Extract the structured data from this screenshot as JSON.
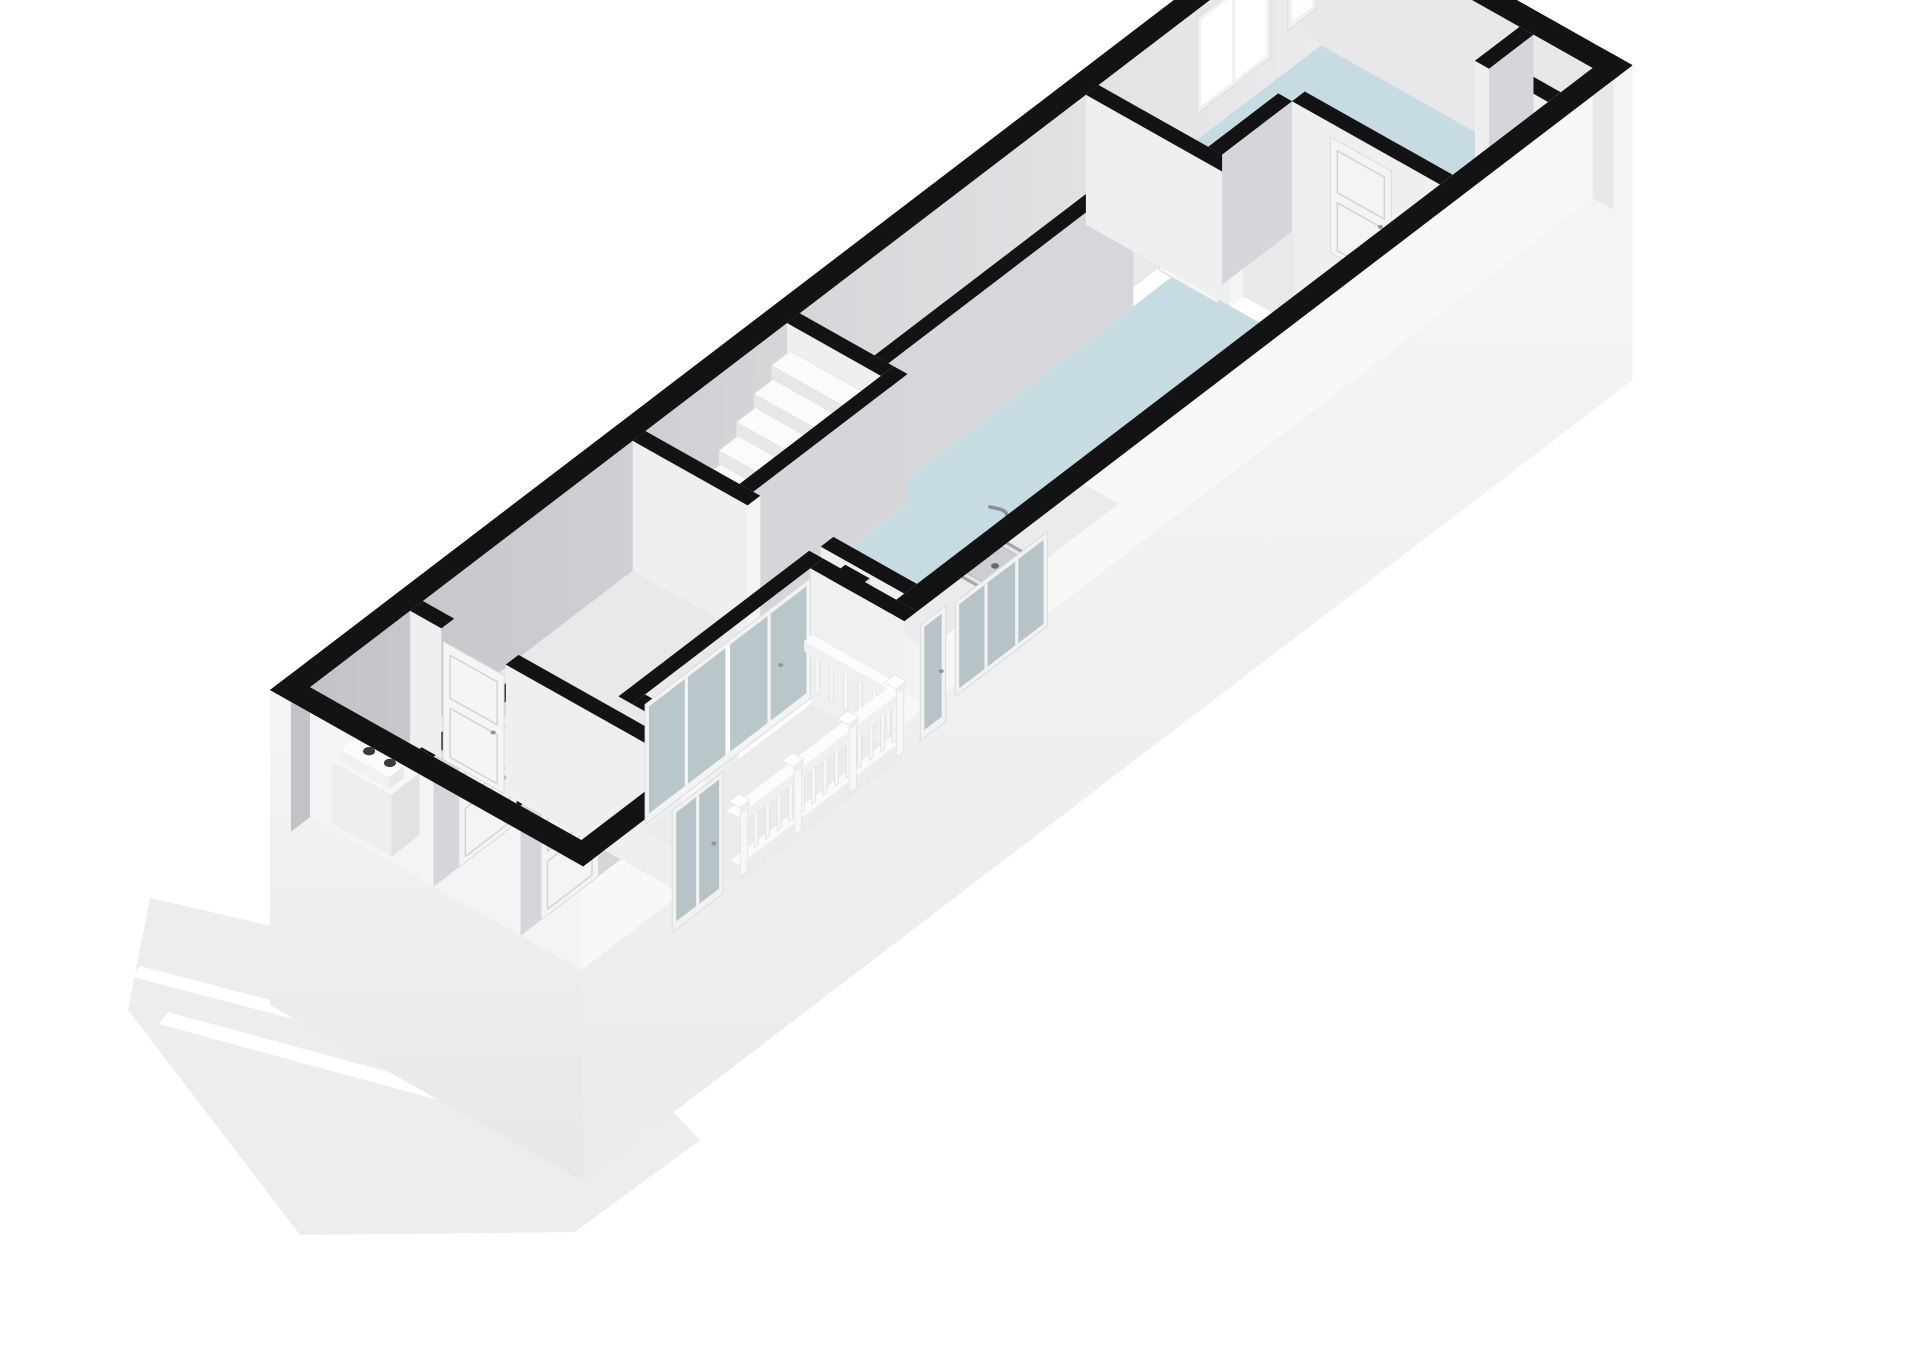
{
  "meta": {
    "width": 1920,
    "height": 1358,
    "background": "#ffffff",
    "description": "3D floor plan render"
  },
  "projection": {
    "ox": 270,
    "oy": 820,
    "ux": 0.795,
    "uy": -0.607,
    "vx": 0.87,
    "vy": 0.49,
    "h": 130,
    "ground": -185
  },
  "palette": {
    "wall_top": "#131315",
    "face_se": "#d6d6da",
    "face_sw": "#eeeff1",
    "cap": "#f5f5f6",
    "floor_gray": "#e9e9eb",
    "floor_blue": "#c7dbe2",
    "glass_pale": "#bac7ca",
    "glass_white": "#ffffff",
    "frame": "#f3f3f4",
    "ground": "#ededee",
    "stripe": "#ffffff",
    "nw_grad": [
      "#c2c2c7",
      "#ececee"
    ],
    "gable_grad": [
      "#f5f5f6",
      "#e7e7e9"
    ],
    "facade_grad": [
      "#f6f6f7",
      "#ebebed"
    ]
  },
  "scene": [
    {
      "name": "ground-plane",
      "type": "sp",
      "pts": [
        [
          150,
          898
        ],
        [
          560,
          992
        ],
        [
          700,
          1140
        ],
        [
          575,
          1232
        ],
        [
          300,
          1235
        ],
        [
          128,
          1010
        ]
      ],
      "fill": "#ededee"
    },
    {
      "name": "ground-stripe-1",
      "type": "sp",
      "pts": [
        [
          168,
          1012
        ],
        [
          565,
          1120
        ],
        [
          556,
          1132
        ],
        [
          159,
          1024
        ]
      ],
      "fill": "#ffffff"
    },
    {
      "name": "ground-stripe-2",
      "type": "sp",
      "pts": [
        [
          140,
          966
        ],
        [
          430,
          1042
        ],
        [
          423,
          1053
        ],
        [
          133,
          977
        ]
      ],
      "fill": "#ffffff"
    },
    {
      "name": "gable-exterior-face",
      "type": "pp",
      "pts": [
        [
          0,
          0,
          130
        ],
        [
          0,
          360,
          130
        ],
        [
          0,
          360,
          -185
        ],
        [
          0,
          0,
          -185
        ]
      ],
      "fill": "url(#gGable)"
    },
    {
      "name": "facade-exterior-face",
      "type": "pp",
      "pts": [
        [
          0,
          360,
          130
        ],
        [
          196,
          360,
          130
        ],
        [
          196,
          360,
          -6
        ],
        [
          404,
          360,
          -6
        ],
        [
          404,
          360,
          130
        ],
        [
          1320,
          360,
          130
        ],
        [
          1320,
          360,
          -185
        ],
        [
          0,
          360,
          -185
        ]
      ],
      "fill": "url(#gFacade)"
    },
    {
      "name": "nw-wall",
      "type": "wu",
      "u": [
        0,
        1320
      ],
      "v": 0,
      "t": 24,
      "face": "url(#gNW)"
    },
    {
      "name": "ne-end-wall",
      "type": "wv",
      "v": [
        0,
        360
      ],
      "u": 1296,
      "t": 24,
      "face": "#e8e8ea",
      "capB": true
    },
    {
      "name": "bedroom-window-large",
      "type": "pan",
      "plane": "v",
      "at": 24,
      "a": [
        1140,
        1232
      ],
      "z": [
        26,
        122
      ],
      "frame": "#f0f0f1",
      "glass": "#ffffff",
      "mull": 1
    },
    {
      "name": "bedroom-window-small",
      "type": "pan",
      "plane": "v",
      "at": 24,
      "a": [
        1254,
        1290
      ],
      "z": [
        40,
        112
      ],
      "frame": "#f0f0f1",
      "glass": "#fdfdfd",
      "mull": 0
    },
    {
      "name": "hall-floor",
      "type": "pp",
      "pts": [
        [
          24,
          24,
          0
        ],
        [
          446,
          24,
          0
        ],
        [
          446,
          336,
          0
        ],
        [
          420,
          336,
          0
        ],
        [
          420,
          236,
          0
        ],
        [
          180,
          236,
          0
        ],
        [
          180,
          336,
          0
        ],
        [
          24,
          336,
          0
        ]
      ],
      "fill": "#e9e9eb"
    },
    {
      "name": "stair-room-floor",
      "type": "pp",
      "pts": [
        [
          446,
          24,
          0
        ],
        [
          624,
          24,
          0
        ],
        [
          624,
          132,
          0
        ],
        [
          446,
          132,
          0
        ]
      ],
      "fill": "#e8e8ea"
    },
    {
      "name": "corridor-floor",
      "type": "pp",
      "pts": [
        [
          640,
          24,
          0
        ],
        [
          1000,
          24,
          0
        ],
        [
          1000,
          110,
          0
        ],
        [
          640,
          110,
          0
        ]
      ],
      "fill": "#e9e9eb"
    },
    {
      "name": "living-room-floor",
      "type": "pp",
      "pts": [
        [
          446,
          148,
          0
        ],
        [
          640,
          148,
          0
        ],
        [
          640,
          126,
          0
        ],
        [
          1000,
          126,
          0
        ],
        [
          1000,
          336,
          0
        ],
        [
          446,
          336,
          0
        ]
      ],
      "fill": "#c7dbe2"
    },
    {
      "name": "ne-closet-floor",
      "type": "pp",
      "pts": [
        [
          1016,
          150,
          0
        ],
        [
          1104,
          150,
          0
        ],
        [
          1104,
          336,
          0
        ],
        [
          1016,
          336,
          0
        ]
      ],
      "fill": "#e9e9eb"
    },
    {
      "name": "bedroom-floor",
      "type": "pp",
      "pts": [
        [
          1016,
          24,
          0
        ],
        [
          1296,
          24,
          0
        ],
        [
          1296,
          336,
          0
        ],
        [
          1120,
          336,
          0
        ],
        [
          1120,
          166,
          0
        ],
        [
          1016,
          166,
          0
        ]
      ],
      "fill": "#c7dbe2"
    },
    {
      "name": "corridor-partition",
      "type": "wu",
      "u": [
        640,
        948
      ],
      "v": 110,
      "t": 16,
      "face": "#d7d7db"
    },
    {
      "name": "living-door-leaf",
      "type": "pan",
      "plane": "u",
      "at": 996,
      "a": [
        112,
        180
      ],
      "z": [
        0,
        118
      ],
      "frame": "#f6f6f7",
      "door": true,
      "handle": true
    },
    {
      "name": "living-ne-partition-low",
      "type": "wv",
      "v": [
        24,
        190
      ],
      "u": 1000,
      "t": 16,
      "capB": true
    },
    {
      "name": "living-ne-partition-high",
      "type": "wv",
      "v": [
        264,
        336
      ],
      "u": 1000,
      "t": 16
    },
    {
      "name": "ne-closet-wall-back",
      "type": "wu",
      "u": [
        1016,
        1104
      ],
      "v": 150,
      "t": 16
    },
    {
      "name": "ne-closet-wall-side",
      "type": "wv",
      "v": [
        166,
        336
      ],
      "u": 1104,
      "t": 16
    },
    {
      "name": "ne-closet-door",
      "type": "pan",
      "plane": "u",
      "at": 1104,
      "a": [
        210,
        280
      ],
      "z": [
        0,
        116
      ],
      "frame": "#f4f4f5",
      "door": true,
      "handle": true
    },
    {
      "name": "corner-niche-wall-side",
      "type": "wv",
      "v": [
        252,
        336
      ],
      "u": 1240,
      "t": 16
    },
    {
      "name": "corner-niche-wall-back",
      "type": "wu",
      "u": [
        1240,
        1296
      ],
      "v": 252,
      "t": 16
    },
    {
      "name": "stair-ne-wall",
      "type": "wv",
      "v": [
        24,
        132
      ],
      "u": 624,
      "t": 16
    },
    {
      "name": "staircase",
      "type": "stair",
      "u0": 468,
      "n": 7,
      "du": 22,
      "v": [
        28,
        128
      ],
      "z0": 14,
      "dz": 15
    },
    {
      "name": "stair-se-wall",
      "type": "wu",
      "u": [
        446,
        640
      ],
      "v": 132,
      "t": 16,
      "capA": true
    },
    {
      "name": "gable-interior-face",
      "type": "pp",
      "pts": [
        [
          24,
          24,
          130
        ],
        [
          24,
          336,
          130
        ],
        [
          24,
          336,
          0
        ],
        [
          24,
          24,
          0
        ]
      ],
      "fill": "#f4f4f6"
    },
    {
      "name": "facade-interior-sw",
      "type": "pp",
      "pts": [
        [
          24,
          336,
          130
        ],
        [
          180,
          336,
          130
        ],
        [
          180,
          336,
          0
        ],
        [
          24,
          336,
          0
        ]
      ],
      "fill": "#f8f8f9"
    },
    {
      "name": "facade-interior-ne",
      "type": "pp",
      "pts": [
        [
          404,
          336,
          130
        ],
        [
          1296,
          336,
          130
        ],
        [
          1296,
          336,
          0
        ],
        [
          404,
          336,
          0
        ]
      ],
      "fill": "#f8f8f9"
    },
    {
      "name": "kitchen-counter",
      "type": "box",
      "u": [
        460,
        700
      ],
      "v": [
        280,
        336
      ],
      "z": [
        0,
        56
      ],
      "top": "#ebebed",
      "sw": "#f3f3f4",
      "nw": "#f0f0f1"
    },
    {
      "name": "kitchen-sink",
      "type": "sink",
      "u": [
        547,
        603
      ],
      "v": [
        290,
        326
      ],
      "z": 56
    },
    {
      "name": "kitchen-faucet",
      "type": "faucet",
      "at": [
        600,
        294,
        56
      ]
    },
    {
      "name": "hall-partition-low",
      "type": "wv",
      "v": [
        24,
        156
      ],
      "u": 430,
      "t": 16,
      "capB": true
    },
    {
      "name": "hall-partition-high",
      "type": "wv",
      "v": [
        240,
        336
      ],
      "u": 430,
      "t": 16
    },
    {
      "name": "duct-pillar",
      "type": "box",
      "u": [
        398,
        426
      ],
      "v": [
        272,
        300
      ],
      "z": [
        0,
        130
      ],
      "top": "#131315",
      "sw": "#ededef",
      "se": "#d8d8db"
    },
    {
      "name": "washing-machine",
      "type": "box",
      "u": [
        30,
        88
      ],
      "v": [
        44,
        112
      ],
      "z": [
        0,
        62
      ],
      "top": "#f7f7f8",
      "sw": "#eeeeef",
      "se": "#e2e2e4"
    },
    {
      "name": "washer-panel",
      "type": "box",
      "u": [
        34,
        52
      ],
      "v": [
        50,
        106
      ],
      "z": [
        62,
        74
      ],
      "top": "#fbfbfc",
      "sw": "#f1f1f2",
      "se": "#e8e8ea"
    },
    {
      "name": "washer-dial-left",
      "type": "el",
      "at": [
        48,
        70,
        74
      ],
      "rx": 6,
      "ry": 4.2,
      "fill": "#3b3b3f"
    },
    {
      "name": "washer-dial-right",
      "type": "el",
      "at": [
        48,
        94,
        74
      ],
      "rx": 6,
      "ry": 4.2,
      "fill": "#3b3b3f"
    },
    {
      "name": "utility-wall-se",
      "type": "wu",
      "u": [
        24,
        150
      ],
      "v": 150,
      "t": 16,
      "capA": true
    },
    {
      "name": "utility-divider",
      "type": "wu",
      "u": [
        24,
        150
      ],
      "v": 252,
      "t": 14
    },
    {
      "name": "utility-door",
      "type": "pan",
      "plane": "v",
      "at": 166,
      "a": [
        56,
        128
      ],
      "z": [
        0,
        116
      ],
      "frame": "#f4f4f5",
      "door": true,
      "handle": true
    },
    {
      "name": "closet-door",
      "type": "pan",
      "plane": "v",
      "at": 266,
      "a": [
        50,
        122
      ],
      "z": [
        0,
        116
      ],
      "frame": "#f4f4f5",
      "door": true,
      "handle": true
    },
    {
      "name": "entry-partition-low",
      "type": "wv",
      "v": [
        24,
        60
      ],
      "u": 150,
      "t": 16
    },
    {
      "name": "entry-partition-high",
      "type": "wv",
      "v": [
        134,
        336
      ],
      "u": 150,
      "t": 16
    },
    {
      "name": "entry-door",
      "type": "pan",
      "plane": "u",
      "at": 150,
      "a": [
        62,
        132
      ],
      "z": [
        0,
        118
      ],
      "frame": "#f5f5f6",
      "door": true,
      "handle": true
    },
    {
      "name": "facade-top-sw",
      "type": "pp",
      "pts": [
        [
          0,
          336,
          130
        ],
        [
          180,
          336,
          130
        ],
        [
          180,
          360,
          130
        ],
        [
          0,
          360,
          130
        ]
      ],
      "fill": "#131315"
    },
    {
      "name": "facade-top-ne",
      "type": "pp",
      "pts": [
        [
          420,
          336,
          130
        ],
        [
          1320,
          336,
          130
        ],
        [
          1320,
          360,
          130
        ],
        [
          420,
          360,
          130
        ]
      ],
      "fill": "#131315"
    },
    {
      "name": "gable-top",
      "type": "pp",
      "pts": [
        [
          0,
          0,
          130
        ],
        [
          24,
          0,
          130
        ],
        [
          24,
          360,
          130
        ],
        [
          0,
          360,
          130
        ]
      ],
      "fill": "#131315"
    },
    {
      "name": "loggia-back-top",
      "type": "pp",
      "pts": [
        [
          180,
          236,
          130
        ],
        [
          420,
          236,
          130
        ],
        [
          420,
          252,
          130
        ],
        [
          180,
          252,
          130
        ]
      ],
      "fill": "#131315"
    },
    {
      "name": "loggia-jamb-ne-face",
      "type": "pp",
      "pts": [
        [
          404,
          252,
          130
        ],
        [
          404,
          360,
          130
        ],
        [
          404,
          360,
          -6
        ],
        [
          404,
          252,
          -6
        ]
      ],
      "fill": "#eff0f2"
    },
    {
      "name": "loggia-jamb-sw-top",
      "type": "pp",
      "pts": [
        [
          180,
          252,
          130
        ],
        [
          196,
          252,
          130
        ],
        [
          196,
          360,
          130
        ],
        [
          180,
          360,
          130
        ]
      ],
      "fill": "#131315"
    },
    {
      "name": "loggia-jamb-ne-top",
      "type": "pp",
      "pts": [
        [
          404,
          252,
          130
        ],
        [
          420,
          252,
          130
        ],
        [
          420,
          360,
          130
        ],
        [
          404,
          360,
          130
        ]
      ],
      "fill": "#131315"
    },
    {
      "name": "loggia-glazing",
      "type": "pan",
      "plane": "v",
      "at": 252,
      "a": [
        196,
        404
      ],
      "z": [
        0,
        120
      ],
      "frame": "#f3f3f4",
      "glass": "#bac7ca",
      "mull": 3,
      "stile": true,
      "handle": true
    },
    {
      "name": "loggia-floor",
      "type": "pp",
      "pts": [
        [
          196,
          252,
          -6
        ],
        [
          404,
          252,
          -6
        ],
        [
          404,
          360,
          -6
        ],
        [
          196,
          360,
          -6
        ]
      ],
      "fill": "#ebebed"
    },
    {
      "name": "facade-door-sw",
      "type": "pan",
      "plane": "v",
      "at": 360,
      "a": [
        112,
        176
      ],
      "z": [
        -4,
        118
      ],
      "frame": "#f2f2f3",
      "glass": "#b7c3c6",
      "mull": 1,
      "handle": true
    },
    {
      "name": "facade-door-ne",
      "type": "pan",
      "plane": "v",
      "at": 360,
      "a": [
        424,
        456
      ],
      "z": [
        -2,
        114
      ],
      "frame": "#f2f2f3",
      "glass": "#b7c3c6",
      "mull": 0,
      "handle": true
    },
    {
      "name": "facade-window-ne",
      "type": "pan",
      "plane": "v",
      "at": 360,
      "a": [
        468,
        584
      ],
      "z": [
        16,
        110
      ],
      "frame": "#f2f2f3",
      "glass": "#b7c3c6",
      "mull": 2
    },
    {
      "name": "balcony-railing-return",
      "type": "railv",
      "u": [
        396,
        406
      ],
      "v": [
        252,
        350
      ],
      "nb": 6
    },
    {
      "name": "balcony-railing-main",
      "type": "rail",
      "u": [
        196,
        404
      ],
      "v": [
        350,
        360
      ],
      "nb": 14
    }
  ]
}
